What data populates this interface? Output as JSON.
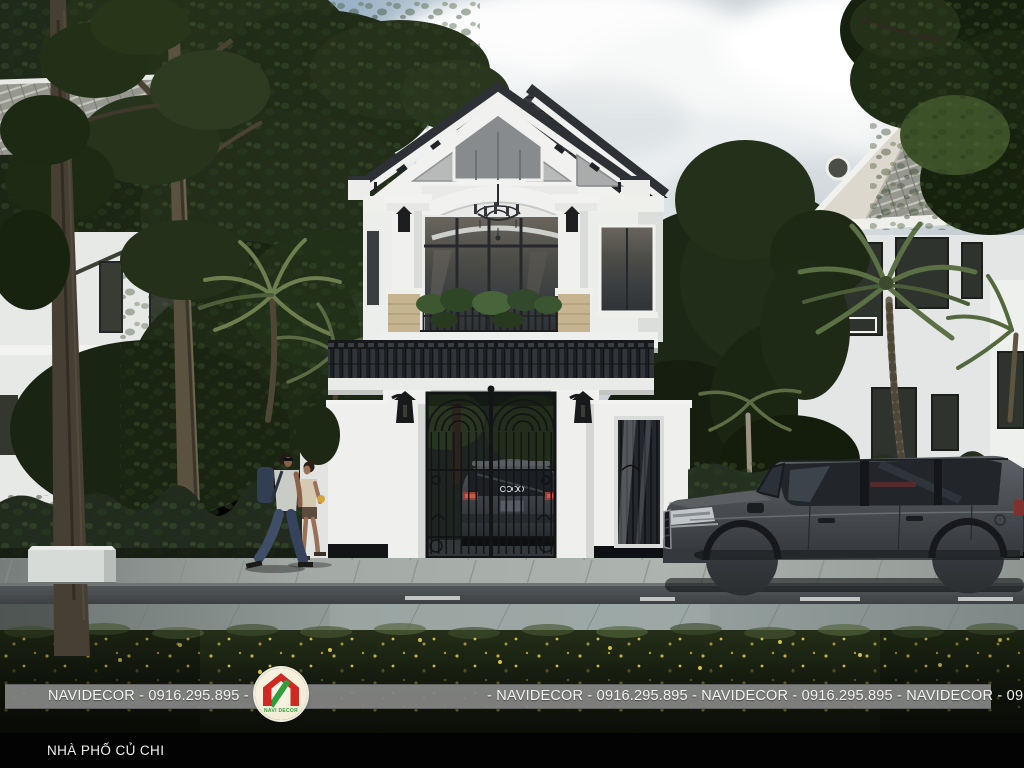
{
  "banner": {
    "left_text": "NAVIDECOR - 0916.295.895 -",
    "right_text": "- NAVIDECOR - 0916.295.895 -  NAVIDECOR - 0916.295.895  - NAVIDECOR - 0916.295.895",
    "background_color": "#8c8d8c",
    "text_color": "#f4f4f2"
  },
  "logo": {
    "name": "NAVI DECOR",
    "red": "#cf2a21",
    "green": "#2f9e3e",
    "background": "#f6f1dd"
  },
  "caption": {
    "text": "NHÀ PHỐ CỦ CHI",
    "bar_color": "#030303",
    "text_color": "#f0f0ee"
  },
  "palette": {
    "sky_blue": "#46739f",
    "cloud_white": "#f7f8f8",
    "wall_white": "#f0f1ef",
    "roof_dark": "#33373b",
    "roof_light_tile": "#96978f",
    "hedge_green": "#222c1e",
    "tree_green": "#243019",
    "road_asphalt": "#45494c",
    "sidewalk_gray": "#a3a9a5",
    "grass_dark": "#151c0f",
    "suv_gray": "#44484c",
    "taillight_red": "#a03a32",
    "stone_tan": "#c6b491"
  }
}
